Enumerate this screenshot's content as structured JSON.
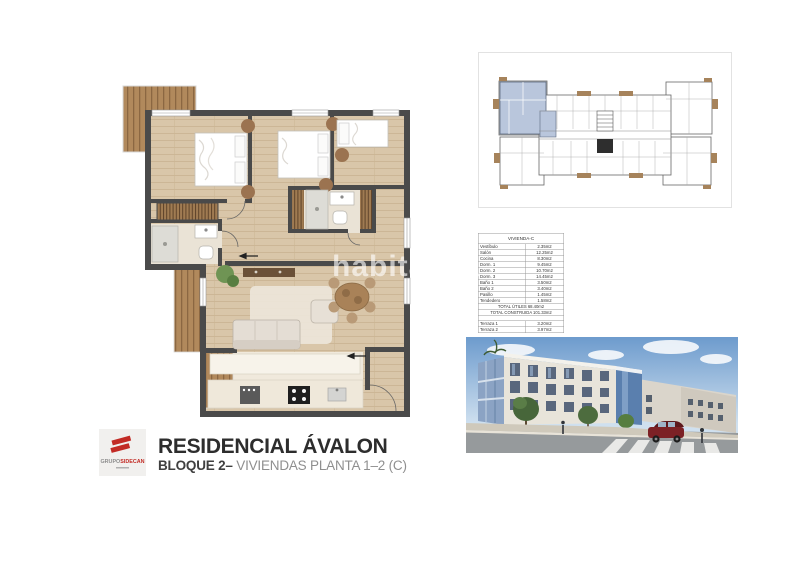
{
  "branding": {
    "logo_text_gray": "GRUPO",
    "logo_text_red": "SIDECAN",
    "title": "RESIDENCIAL ÁVALON",
    "subtitle_strong": "BLOQUE 2–",
    "subtitle_light": " VIVIENDAS PLANTA 1–2  (C)",
    "accent_red": "#c22b25"
  },
  "watermark": {
    "text": "habitaclia"
  },
  "area_table": {
    "header": "VIVIENDA-C",
    "rows": [
      {
        "label": "Vestíbulo",
        "value": "2.35m2"
      },
      {
        "label": "Salón",
        "value": "12.25m2"
      },
      {
        "label": "Cocina",
        "value": "8.30m2"
      },
      {
        "label": "Dorm. 1",
        "value": "9.45m2"
      },
      {
        "label": "Dorm. 2",
        "value": "10.70m2"
      },
      {
        "label": "Dorm. 3",
        "value": "14.45m2"
      },
      {
        "label": "Baño 1",
        "value": "3.50m2"
      },
      {
        "label": "Baño 2",
        "value": "3.40m2"
      },
      {
        "label": "Pasillo",
        "value": "1.45m2"
      },
      {
        "label": "Tendedero",
        "value": "1.58m2"
      }
    ],
    "total_utiles": "TOTAL ÚTILES 68.40m2",
    "total_construida": "TOTAL CONSTRUIDA 101.33m2",
    "terraces": [
      {
        "label": "Terraza 1",
        "value": "3.20m2"
      },
      {
        "label": "Terraza 2",
        "value": "3.97m2"
      }
    ]
  },
  "key_plan": {
    "highlighted_unit": "C",
    "highlight_color": "#b9c6dc"
  },
  "colors": {
    "wall": "#4a4a4a",
    "wood_floor": "#d9c6a9",
    "deck": "#b1895c",
    "brand_red": "#c22b25"
  }
}
